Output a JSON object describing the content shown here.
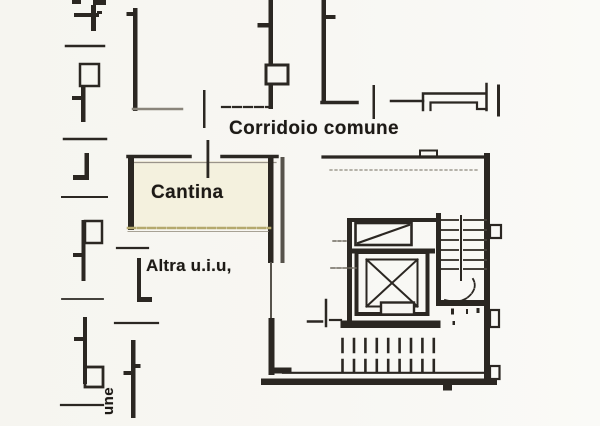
{
  "document": {
    "type": "cadastral-floor-plan-scan",
    "background_color": "#f7f6f2",
    "ink_color": "#2b2722",
    "faint_ink_color": "#6e685e",
    "unit_highlight_color": "#f4f1de",
    "boundary_highlight_color": "#b4a96d"
  },
  "labels": {
    "corridor": "Corridoio comune",
    "cellar": "Cantina",
    "other_unit": "Altra u.i.u,",
    "edge_vertical": "une"
  }
}
